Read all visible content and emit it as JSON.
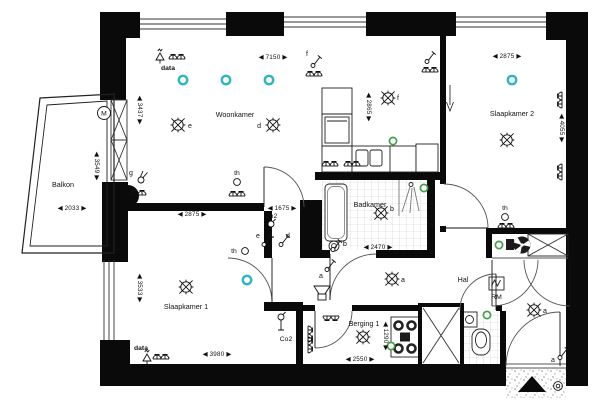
{
  "rooms": {
    "balkon": "Balkon",
    "woonkamer": "Woonkamer",
    "slaapkamer1": "Slaapkamer 1",
    "slaapkamer2": "Slaapkamer 2",
    "badkamer": "Badkamer",
    "hal": "Hal",
    "berging": "Berging 1"
  },
  "dims": {
    "woonkamer_w": "◀ 7150 ▶",
    "slaapkamer2_w": "◀ 2875 ▶",
    "balkon_w": "◀ 2033 ▶",
    "slaapkamer1_w": "◀ 2875 ▶",
    "gang_w": "◀ 1675 ▶",
    "badkamer_w": "◀ 2470 ▶",
    "slaapkamer1_b": "◀ 3980 ▶",
    "berging_w": "◀ 2550 ▶",
    "woonkamer_h": "◀ 3437 ▶",
    "balkon_h": "◀ 3549 ▶",
    "keuken_h": "◀ 2865 ▶",
    "slaapkamer2_h": "◀ 4055 ▶",
    "badkamer_h": "◀ 1620 ▶",
    "slaapkamer1_h": "◀ 3533 ▶",
    "berging_h": "◀ 1290 ▶"
  },
  "labels": {
    "data_top": "data",
    "data_bottom": "data",
    "co2_top": "Co2",
    "co2_bottom": "Co2",
    "th_woonkamer": "th",
    "th_slaapkamer1": "th",
    "th_hal": "th",
    "rm": "RM",
    "motor": "M",
    "light_e": "e",
    "light_d": "d",
    "light_f": "f",
    "light_b": "b",
    "light_a_hal": "a",
    "light_a_toilet": "a",
    "switch_e": "e",
    "switch_d": "d",
    "switch_f": "f",
    "switch_b": "b",
    "switch_a_hal": "a",
    "switch_a_entry": "a",
    "lamp_g": "g"
  },
  "legend": {
    "smoke_detector_color": "#2fb4c6",
    "sensor_color": "#43a047",
    "wall_color": "#0a0a0a"
  }
}
